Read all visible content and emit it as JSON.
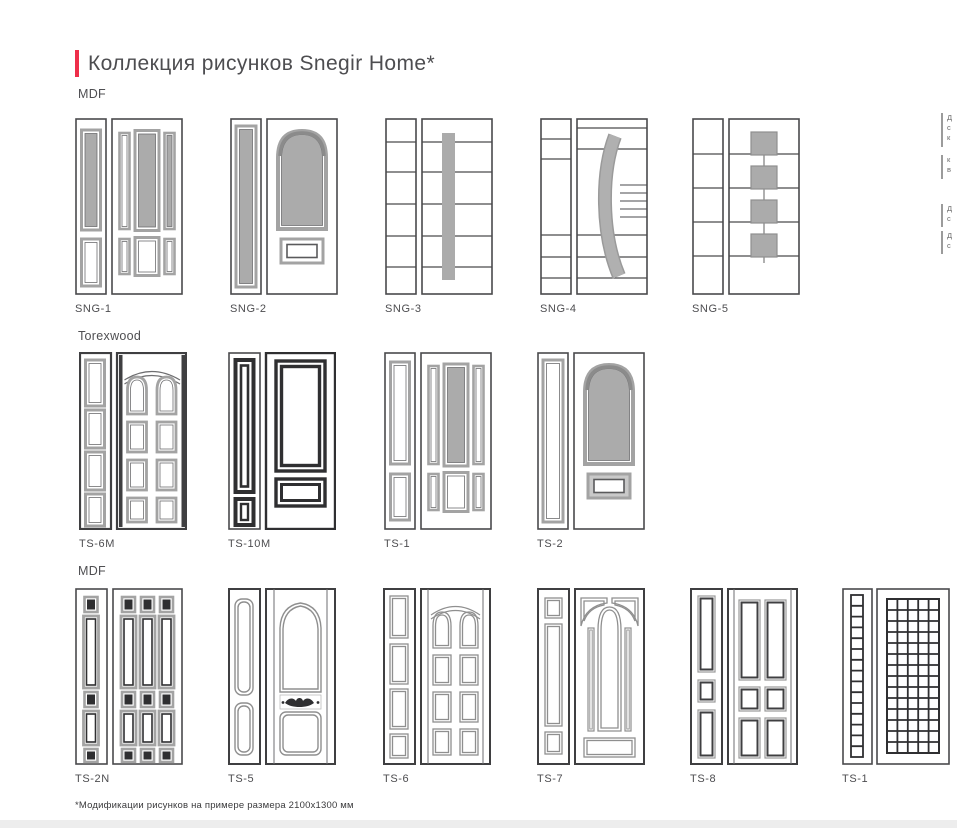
{
  "page": {
    "title": "Коллекция рисунков Snegir Home*",
    "footnote": "*Модификации рисунков на примере размера 2100x1300 мм"
  },
  "colors": {
    "accent_red": "#ee2e4a",
    "panel_gray_fill": "#ababab",
    "frame_gray": "#a3a3a3",
    "outline_dark": "#4a4a4c",
    "heavy_frame_black": "#2f2f31"
  },
  "sections": [
    {
      "material": "MDF",
      "doors": [
        {
          "label": "SNG-1"
        },
        {
          "label": "SNG-2"
        },
        {
          "label": "SNG-3"
        },
        {
          "label": "SNG-4"
        },
        {
          "label": "SNG-5"
        }
      ]
    },
    {
      "material": "Torexwood",
      "doors": [
        {
          "label": "TS-6M"
        },
        {
          "label": "TS-10M"
        },
        {
          "label": "TS-1"
        },
        {
          "label": "TS-2"
        }
      ]
    },
    {
      "material": "MDF",
      "doors": [
        {
          "label": "TS-2N"
        },
        {
          "label": "TS-5"
        },
        {
          "label": "TS-6"
        },
        {
          "label": "TS-7"
        },
        {
          "label": "TS-8"
        },
        {
          "label": "TS-1"
        }
      ]
    }
  ],
  "margin_notes": [
    {
      "fragments": [
        "Д",
        "с",
        "к"
      ]
    },
    {
      "fragments": [
        "к",
        "в"
      ]
    },
    {
      "fragments": [
        "Д",
        "с"
      ]
    },
    {
      "fragments": [
        "Д",
        "с"
      ]
    }
  ]
}
